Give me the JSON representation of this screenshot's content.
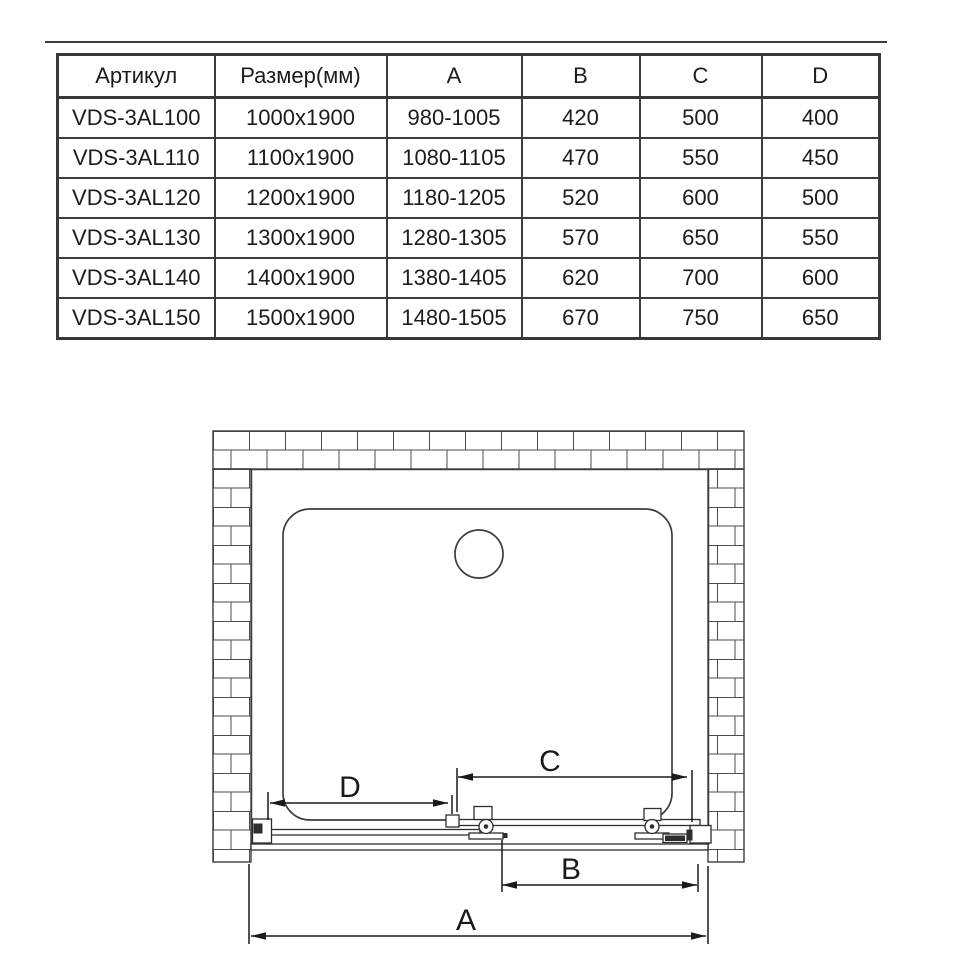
{
  "page": {
    "background": "#ffffff",
    "rule_color": "#3c3c3c"
  },
  "table": {
    "text_color": "#1c1c1c",
    "border_color": "#3c3c3c",
    "headers": [
      "Артикул",
      "Размер(мм)",
      "A",
      "B",
      "C",
      "D"
    ],
    "rows": [
      [
        "VDS-3AL100",
        "1000x1900",
        "980-1005",
        "420",
        "500",
        "400"
      ],
      [
        "VDS-3AL110",
        "1100x1900",
        "1080-1105",
        "470",
        "550",
        "450"
      ],
      [
        "VDS-3AL120",
        "1200x1900",
        "1180-1205",
        "520",
        "600",
        "500"
      ],
      [
        "VDS-3AL130",
        "1300x1900",
        "1280-1305",
        "570",
        "650",
        "550"
      ],
      [
        "VDS-3AL140",
        "1400x1900",
        "1380-1405",
        "620",
        "700",
        "600"
      ],
      [
        "VDS-3AL150",
        "1500x1900",
        "1480-1505",
        "670",
        "750",
        "650"
      ]
    ]
  },
  "drawing": {
    "labels": {
      "a": "A",
      "b": "B",
      "c": "C",
      "d": "D"
    },
    "line_color": "#3d3d3d",
    "dim_color": "#1a1a1a",
    "brick_color": "#4d4d4d"
  }
}
